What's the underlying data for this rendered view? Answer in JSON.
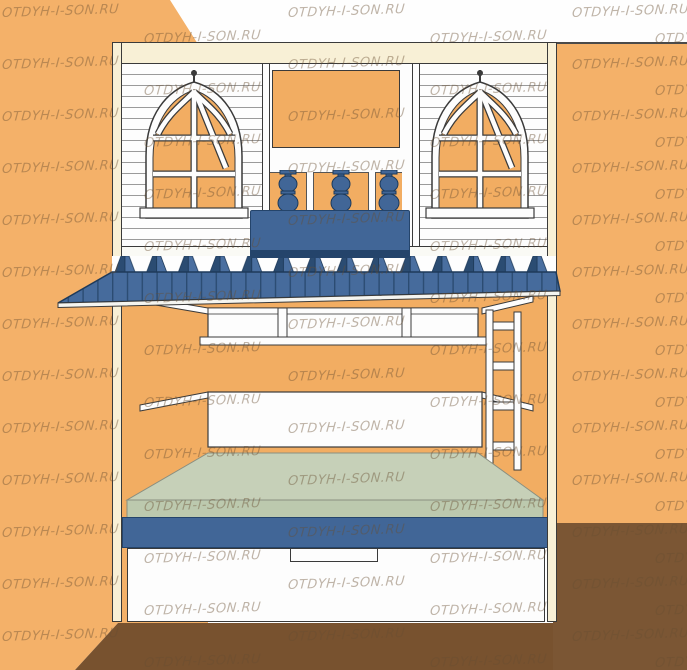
{
  "watermark": {
    "text": "OTDYH-I-SON.RU",
    "color": "rgba(105,78,50,0.42)",
    "rows": [
      {
        "y": 4,
        "xs": [
          2,
          288,
          572
        ]
      },
      {
        "y": 30,
        "xs": [
          144,
          430,
          655
        ]
      },
      {
        "y": 56,
        "xs": [
          2,
          288,
          572
        ]
      },
      {
        "y": 82,
        "xs": [
          144,
          430,
          655
        ]
      },
      {
        "y": 108,
        "xs": [
          2,
          288,
          572
        ]
      },
      {
        "y": 134,
        "xs": [
          144,
          430,
          655
        ]
      },
      {
        "y": 160,
        "xs": [
          2,
          288,
          572
        ]
      },
      {
        "y": 186,
        "xs": [
          144,
          430,
          655
        ]
      },
      {
        "y": 212,
        "xs": [
          2,
          288,
          572
        ]
      },
      {
        "y": 238,
        "xs": [
          144,
          430,
          655
        ]
      },
      {
        "y": 264,
        "xs": [
          2,
          288,
          572
        ]
      },
      {
        "y": 290,
        "xs": [
          144,
          430,
          655
        ]
      },
      {
        "y": 316,
        "xs": [
          2,
          288,
          572
        ]
      },
      {
        "y": 342,
        "xs": [
          144,
          430,
          655
        ]
      },
      {
        "y": 368,
        "xs": [
          2,
          288,
          572
        ]
      },
      {
        "y": 394,
        "xs": [
          144,
          430,
          655
        ]
      },
      {
        "y": 420,
        "xs": [
          2,
          288,
          572
        ]
      },
      {
        "y": 446,
        "xs": [
          144,
          430,
          655
        ]
      },
      {
        "y": 472,
        "xs": [
          2,
          288,
          572
        ]
      },
      {
        "y": 498,
        "xs": [
          144,
          430,
          655
        ]
      },
      {
        "y": 524,
        "xs": [
          2,
          288,
          572
        ]
      },
      {
        "y": 550,
        "xs": [
          144,
          430,
          655
        ]
      },
      {
        "y": 576,
        "xs": [
          2,
          288,
          572
        ]
      },
      {
        "y": 602,
        "xs": [
          144,
          430,
          655
        ]
      },
      {
        "y": 628,
        "xs": [
          2,
          288,
          572
        ]
      },
      {
        "y": 654,
        "xs": [
          144,
          430,
          655
        ]
      }
    ]
  },
  "subject": {
    "type": "furniture-product-render",
    "item": "house-shaped loft bed: gothic windows, balcony with planter box, blue shingled awning, lower bunk with green mattress and drawer",
    "window_count": 2,
    "baluster_count": 3,
    "shingle_teeth_count": 14,
    "ladder_rung_count": 4
  },
  "palette": {
    "wall_orange": "#F4B169",
    "floor_brown": "#78522F",
    "floor_brown_right": "#7B5634",
    "frame_cream": "#F8F0D6",
    "panel_white": "#FDFDFD",
    "outline_dark": "#3A3A3A",
    "accent_blue": "#416697",
    "accent_blue_dark": "#24446B",
    "shingle_shadow": "#2B4C72",
    "mattress_green_top": "#C6D0B8",
    "mattress_green_front": "#BCC9AE",
    "wall_top_edge_line": "#4A4A4A"
  }
}
